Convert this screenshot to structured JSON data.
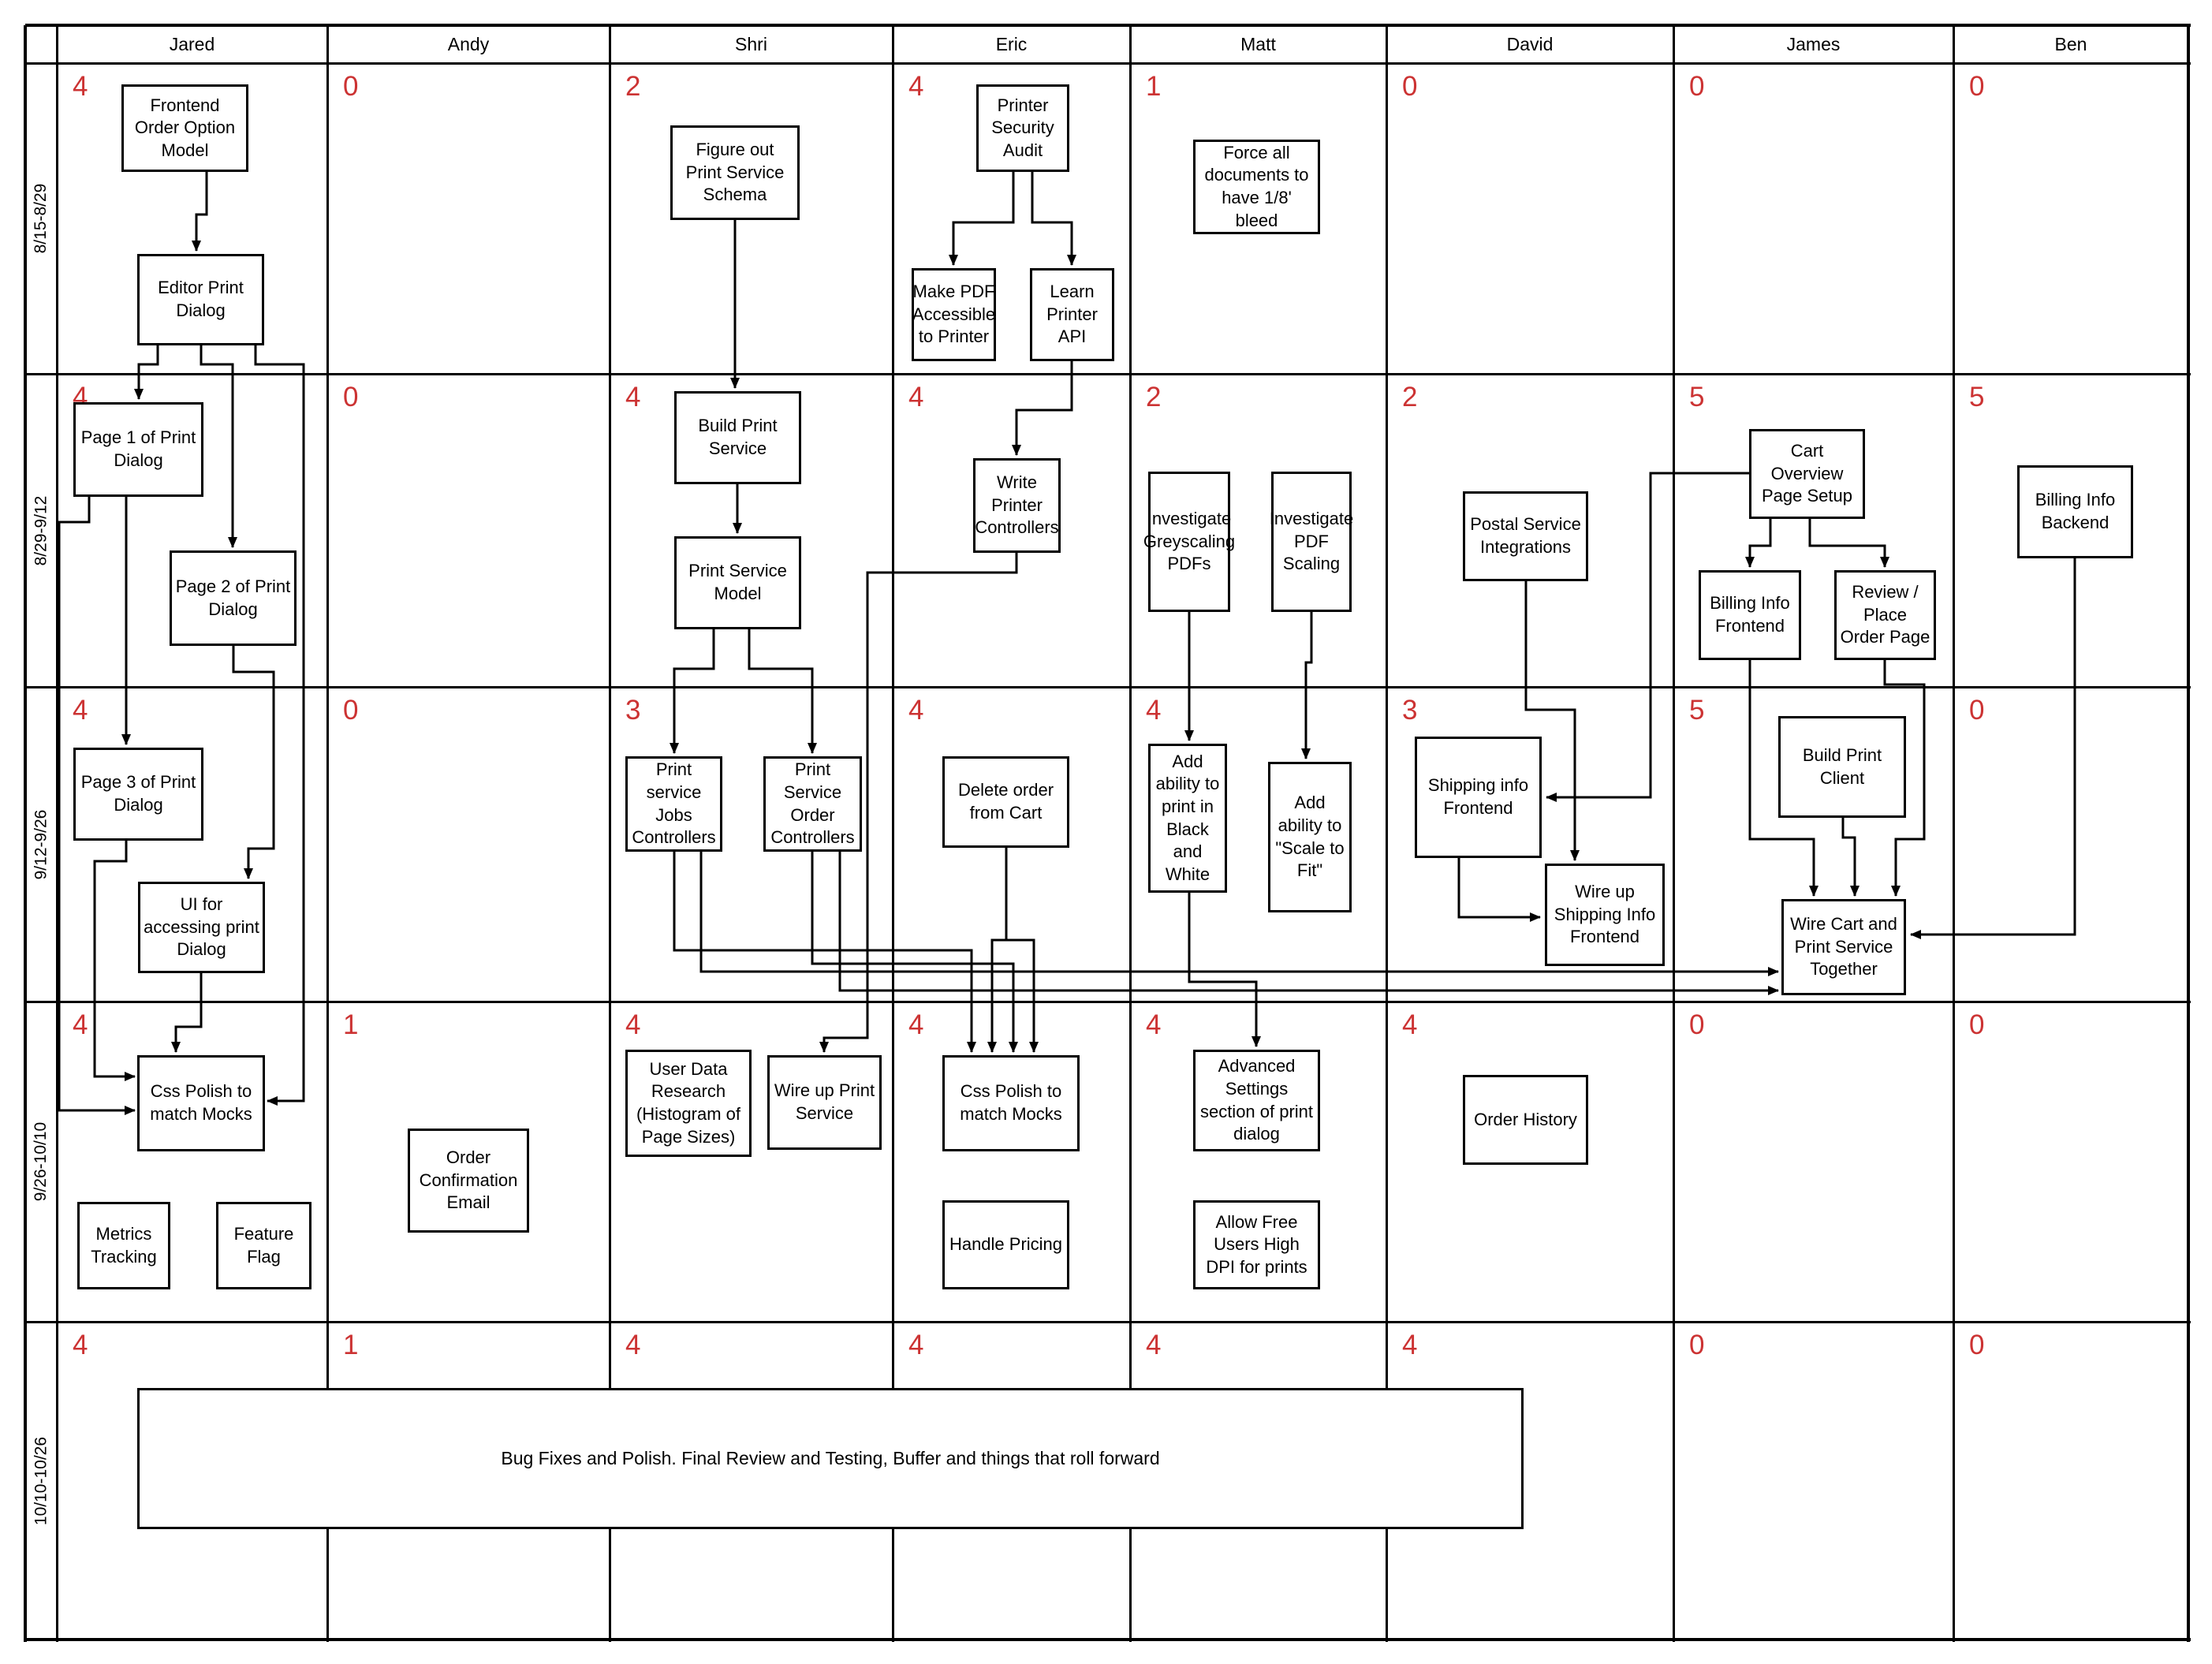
{
  "diagram_title": "",
  "columns": [
    "Jared",
    "Andy",
    "Shri",
    "Eric",
    "Matt",
    "David",
    "James",
    "Ben"
  ],
  "row_labels": [
    "8/15-8/29",
    "8/29-9/12",
    "9/12-9/26",
    "9/26-10/10",
    "10/10-10/26"
  ],
  "counts": [
    [
      4,
      0,
      2,
      4,
      1,
      0,
      0,
      0
    ],
    [
      4,
      0,
      4,
      4,
      2,
      2,
      5,
      5
    ],
    [
      4,
      0,
      3,
      4,
      4,
      3,
      5,
      0
    ],
    [
      4,
      1,
      4,
      4,
      4,
      4,
      0,
      0
    ],
    [
      4,
      1,
      4,
      4,
      4,
      4,
      0,
      0
    ]
  ],
  "accent": {
    "count_color": "#cc3333",
    "line_color": "#000000"
  },
  "tasks": [
    {
      "id": "foom",
      "owner": "Jared",
      "period": "8/15-8/29",
      "label": "Frontend Order Option Model"
    },
    {
      "id": "epd",
      "owner": "Jared",
      "period": "8/15-8/29",
      "label": "Editor Print Dialog"
    },
    {
      "id": "fpss",
      "owner": "Shri",
      "period": "8/15-8/29",
      "label": "Figure out Print Service Schema"
    },
    {
      "id": "psa",
      "owner": "Eric",
      "period": "8/15-8/29",
      "label": "Printer Security Audit"
    },
    {
      "id": "mpa",
      "owner": "Eric",
      "period": "8/15-8/29",
      "label": "Make PDF Accessible to Printer"
    },
    {
      "id": "lpa",
      "owner": "Eric",
      "period": "8/15-8/29",
      "label": "Learn Printer API"
    },
    {
      "id": "fad",
      "owner": "Matt",
      "period": "8/15-8/29",
      "label": "Force all documents to have 1/8' bleed"
    },
    {
      "id": "p1",
      "owner": "Jared",
      "period": "8/29-9/12",
      "label": "Page 1 of Print Dialog"
    },
    {
      "id": "p2",
      "owner": "Jared",
      "period": "8/29-9/12",
      "label": "Page 2 of Print Dialog"
    },
    {
      "id": "bps",
      "owner": "Shri",
      "period": "8/29-9/12",
      "label": "Build Print Service"
    },
    {
      "id": "psm",
      "owner": "Shri",
      "period": "8/29-9/12",
      "label": "Print Service Model"
    },
    {
      "id": "wpc",
      "owner": "Eric",
      "period": "8/29-9/12",
      "label": "Write Printer Controllers"
    },
    {
      "id": "igp",
      "owner": "Matt",
      "period": "8/29-9/12",
      "label": "Investigate Greyscaling PDFs"
    },
    {
      "id": "ips",
      "owner": "Matt",
      "period": "8/29-9/12",
      "label": "Investigate PDF Scaling"
    },
    {
      "id": "psi",
      "owner": "David",
      "period": "8/29-9/12",
      "label": "Postal Service Integrations"
    },
    {
      "id": "cops",
      "owner": "James",
      "period": "8/29-9/12",
      "label": "Cart Overview Page Setup"
    },
    {
      "id": "bif",
      "owner": "James",
      "period": "8/29-9/12",
      "label": "Billing Info Frontend"
    },
    {
      "id": "rpop",
      "owner": "James",
      "period": "8/29-9/12",
      "label": "Review / Place Order Page"
    },
    {
      "id": "bib",
      "owner": "Ben",
      "period": "8/29-9/12",
      "label": "Billing Info Backend"
    },
    {
      "id": "p3",
      "owner": "Jared",
      "period": "9/12-9/26",
      "label": "Page 3 of Print Dialog"
    },
    {
      "id": "ui",
      "owner": "Jared",
      "period": "9/12-9/26",
      "label": "UI for accessing print Dialog"
    },
    {
      "id": "psjc",
      "owner": "Shri",
      "period": "9/12-9/26",
      "label": "Print service Jobs Controllers"
    },
    {
      "id": "psoc",
      "owner": "Shri",
      "period": "9/12-9/26",
      "label": "Print Service Order Controllers"
    },
    {
      "id": "dofc",
      "owner": "Eric",
      "period": "9/12-9/26",
      "label": "Delete order from Cart"
    },
    {
      "id": "aabw",
      "owner": "Matt",
      "period": "9/12-9/26",
      "label": "Add ability to print in Black and White"
    },
    {
      "id": "astf",
      "owner": "Matt",
      "period": "9/12-9/26",
      "label": "Add ability to \"Scale to Fit\""
    },
    {
      "id": "sif",
      "owner": "David",
      "period": "9/12-9/26",
      "label": "Shipping info Frontend"
    },
    {
      "id": "wusif",
      "owner": "David",
      "period": "9/12-9/26",
      "label": "Wire up Shipping Info Frontend"
    },
    {
      "id": "bpc",
      "owner": "James",
      "period": "9/12-9/26",
      "label": "Build Print Client"
    },
    {
      "id": "wcps",
      "owner": "James",
      "period": "9/12-9/26",
      "label": "Wire Cart and Print Service Together"
    },
    {
      "id": "cpmj",
      "owner": "Jared",
      "period": "9/26-10/10",
      "label": "Css Polish to match Mocks"
    },
    {
      "id": "mt",
      "owner": "Jared",
      "period": "9/26-10/10",
      "label": "Metrics Tracking"
    },
    {
      "id": "ff",
      "owner": "Jared",
      "period": "9/26-10/10",
      "label": "Feature Flag"
    },
    {
      "id": "oce",
      "owner": "Andy",
      "period": "9/26-10/10",
      "label": "Order Confirmation Email"
    },
    {
      "id": "udr",
      "owner": "Shri",
      "period": "9/26-10/10",
      "label": "User Data Research (Histogram of Page Sizes)"
    },
    {
      "id": "wups",
      "owner": "Shri",
      "period": "9/26-10/10",
      "label": "Wire up Print Service"
    },
    {
      "id": "cpme",
      "owner": "Eric",
      "period": "9/26-10/10",
      "label": "Css Polish to match Mocks"
    },
    {
      "id": "hp",
      "owner": "Eric",
      "period": "9/26-10/10",
      "label": "Handle Pricing"
    },
    {
      "id": "ass",
      "owner": "Matt",
      "period": "9/26-10/10",
      "label": "Advanced Settings section of print dialog"
    },
    {
      "id": "afu",
      "owner": "Matt",
      "period": "9/26-10/10",
      "label": "Allow Free Users High DPI for prints"
    },
    {
      "id": "oh",
      "owner": "David",
      "period": "9/26-10/10",
      "label": "Order History"
    },
    {
      "id": "bugs",
      "owner": "Team",
      "period": "10/10-10/26",
      "label": "Bug Fixes and Polish. Final Review and Testing, Buffer and things that roll forward"
    }
  ],
  "edges": [
    {
      "from": "foom",
      "to": "epd"
    },
    {
      "from": "epd",
      "to": "p1"
    },
    {
      "from": "epd",
      "to": "p2"
    },
    {
      "from": "epd",
      "to": "cpmj"
    },
    {
      "from": "p1",
      "to": "p3"
    },
    {
      "from": "p1",
      "to": "cpmj"
    },
    {
      "from": "p2",
      "to": "ui"
    },
    {
      "from": "p3",
      "to": "cpmj"
    },
    {
      "from": "ui",
      "to": "cpmj"
    },
    {
      "from": "fpss",
      "to": "bps"
    },
    {
      "from": "bps",
      "to": "psm"
    },
    {
      "from": "psm",
      "to": "psjc"
    },
    {
      "from": "psm",
      "to": "psoc"
    },
    {
      "from": "psa",
      "to": "mpa"
    },
    {
      "from": "psa",
      "to": "lpa"
    },
    {
      "from": "lpa",
      "to": "wpc"
    },
    {
      "from": "wpc",
      "to": "wups"
    },
    {
      "from": "dofc",
      "to": "cpme"
    },
    {
      "from": "dofc",
      "to": "cpme"
    },
    {
      "from": "psjc",
      "to": "cpme"
    },
    {
      "from": "psoc",
      "to": "cpme"
    },
    {
      "from": "psjc",
      "to": "wcps"
    },
    {
      "from": "psoc",
      "to": "wcps"
    },
    {
      "from": "igp",
      "to": "aabw"
    },
    {
      "from": "ips",
      "to": "astf"
    },
    {
      "from": "aabw",
      "to": "ass"
    },
    {
      "from": "psi",
      "to": "wusif"
    },
    {
      "from": "cops",
      "to": "sif"
    },
    {
      "from": "sif",
      "to": "wusif"
    },
    {
      "from": "cops",
      "to": "bif"
    },
    {
      "from": "cops",
      "to": "rpop"
    },
    {
      "from": "bpc",
      "to": "wcps"
    },
    {
      "from": "bif",
      "to": "wcps"
    },
    {
      "from": "rpop",
      "to": "wcps"
    },
    {
      "from": "bib",
      "to": "wcps"
    }
  ]
}
